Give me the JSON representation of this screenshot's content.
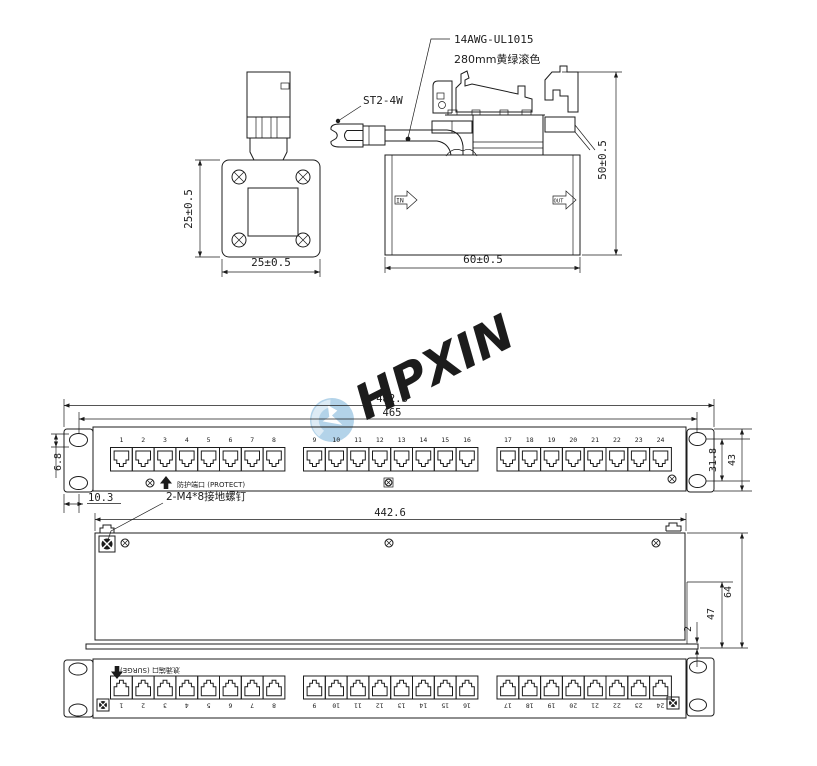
{
  "watermark": {
    "text": "HPXIN",
    "color": "#b3d3e9"
  },
  "module_front": {
    "dim_height": "25±0.5",
    "dim_width": "25±0.5"
  },
  "module_side": {
    "wire_spec_line1": "14AWG-UL1015",
    "wire_spec_line2": "280mm黄绿滚色",
    "terminal_label": "ST2-4W",
    "in_label": "IN",
    "out_label": "OUT",
    "dim_width": "60±0.5",
    "dim_height": "50±0.5"
  },
  "panel_front": {
    "dim_overall_width": "482.6",
    "dim_hole_span": "465",
    "dim_slot_height": "6.8",
    "dim_hole_offset": "10.3",
    "dim_hole_pitch": "31.8",
    "dim_panel_height": "43",
    "protect_label": "防护端口 (PROTECT)",
    "port_numbers": [
      "1",
      "2",
      "3",
      "4",
      "5",
      "6",
      "7",
      "8",
      "9",
      "10",
      "11",
      "12",
      "13",
      "14",
      "15",
      "16",
      "17",
      "18",
      "19",
      "20",
      "21",
      "22",
      "23",
      "24"
    ]
  },
  "panel_rear": {
    "ground_screw_label": "2-M4*8接地螺钉",
    "dim_body_width": "442.6",
    "dim_depth": "47",
    "dim_lip": "2",
    "dim_total_depth": "64"
  },
  "panel_bottom": {
    "surge_label": "浪涌端口 (SURGE)",
    "port_numbers": [
      "1",
      "2",
      "3",
      "4",
      "5",
      "6",
      "7",
      "8",
      "9",
      "10",
      "11",
      "12",
      "13",
      "14",
      "15",
      "16",
      "17",
      "18",
      "19",
      "20",
      "21",
      "22",
      "23",
      "24"
    ]
  }
}
